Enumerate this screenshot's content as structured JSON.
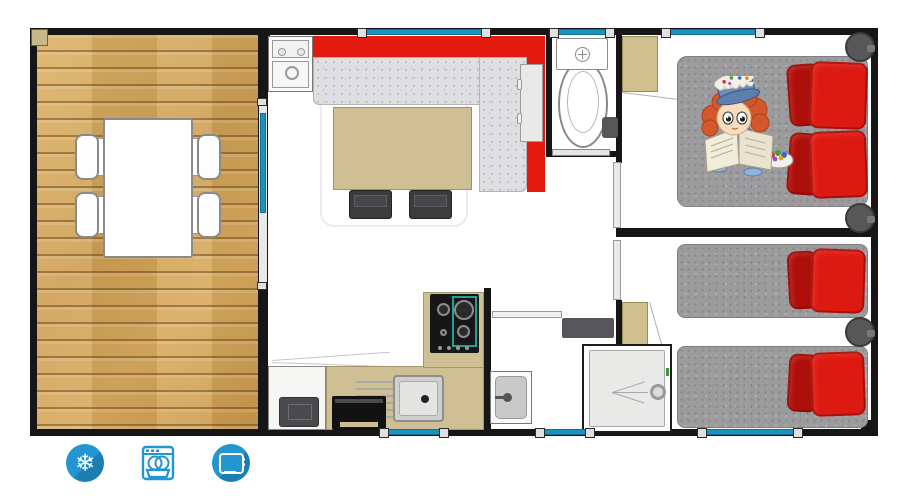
{
  "document": {
    "type": "mobile-home floor plan",
    "orientation": "top-down"
  },
  "colors": {
    "wall": "#161616",
    "deck_wood": "#d0a35b",
    "sofa_red": "#e31a0e",
    "seat_gray": "#dfdfe2",
    "table_tan": "#cec094",
    "wood_tan": "#cfc08e",
    "chair_dark": "#3c3c3e",
    "window_teal": "#1b93c0",
    "bed_gray": "#9c9c9e",
    "pillow_red": "#dd1a12",
    "pillow_dark": "#ad0f0b",
    "stool_gray": "#57575a",
    "shower_floor": "#e9e9e7",
    "icon_blue": "#2396d2"
  },
  "amenities": [
    {
      "name": "freezer",
      "icon": "snowflake-icon",
      "glyph": "❄"
    },
    {
      "name": "dishwasher",
      "icon": "dishwasher-icon"
    },
    {
      "name": "tv",
      "icon": "tv-icon"
    }
  ]
}
